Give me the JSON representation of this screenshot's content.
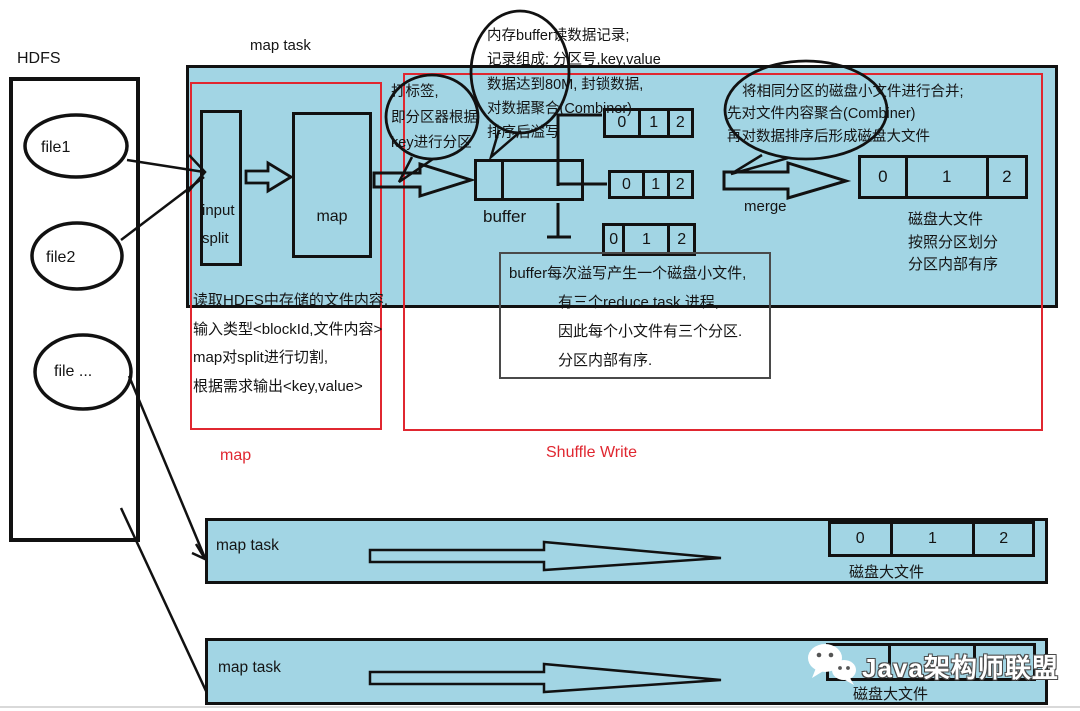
{
  "colors": {
    "panel_blue": "#a2d5e4",
    "accent_red": "#e02730",
    "line_black": "#111111"
  },
  "hdfs": {
    "title": "HDFS",
    "files": [
      "file1",
      "file2",
      "file ..."
    ]
  },
  "map_task": {
    "title": "map task",
    "input_split": [
      "input",
      "split"
    ],
    "map_label": "map",
    "buffer_label": "buffer",
    "spill_files": [
      [
        "0",
        "1",
        "2"
      ],
      [
        "0",
        "1",
        "2"
      ],
      [
        "0",
        "1",
        "2"
      ]
    ]
  },
  "bubbles": {
    "memory": [
      "内存buffer读数据记录;",
      "记录组成: 分区号,key,value",
      "数据达到80M, 封锁数据,",
      "对数据聚合(Combiner)",
      "排序后溢写"
    ],
    "tag": [
      "打标签,",
      "即分区器根据",
      "key进行分区"
    ],
    "merge": [
      "将相同分区的磁盘小文件进行合并;",
      "先对文件内容聚合(Combiner)",
      "再对数据排序后形成磁盘大文件"
    ]
  },
  "notes": {
    "read": [
      "读取HDFS中存储的文件内容,",
      "输入类型<blockId,文件内容>",
      "map对split进行切割,",
      "根据需求输出<key,value>"
    ],
    "spill": [
      "buffer每次溢写产生一个磁盘小文件,",
      "有三个reduce task 进程,",
      "因此每个小文件有三个分区.",
      "分区内部有序."
    ],
    "bigfile": [
      "磁盘大文件",
      "按照分区划分",
      "分区内部有序"
    ]
  },
  "merge_section": {
    "arrow_label": "merge",
    "big_file_cells": [
      "0",
      "1",
      "2"
    ]
  },
  "section_labels": {
    "map": "map",
    "shuffle": "Shuffle Write"
  },
  "bottom_rows": [
    {
      "label": "map task",
      "cells": [
        "0",
        "1",
        "2"
      ],
      "caption": "磁盘大文件"
    },
    {
      "label": "map task",
      "cells": [
        "",
        "",
        ""
      ],
      "caption": "磁盘大文件"
    }
  ],
  "watermark": {
    "text": "Java架构师联盟"
  }
}
